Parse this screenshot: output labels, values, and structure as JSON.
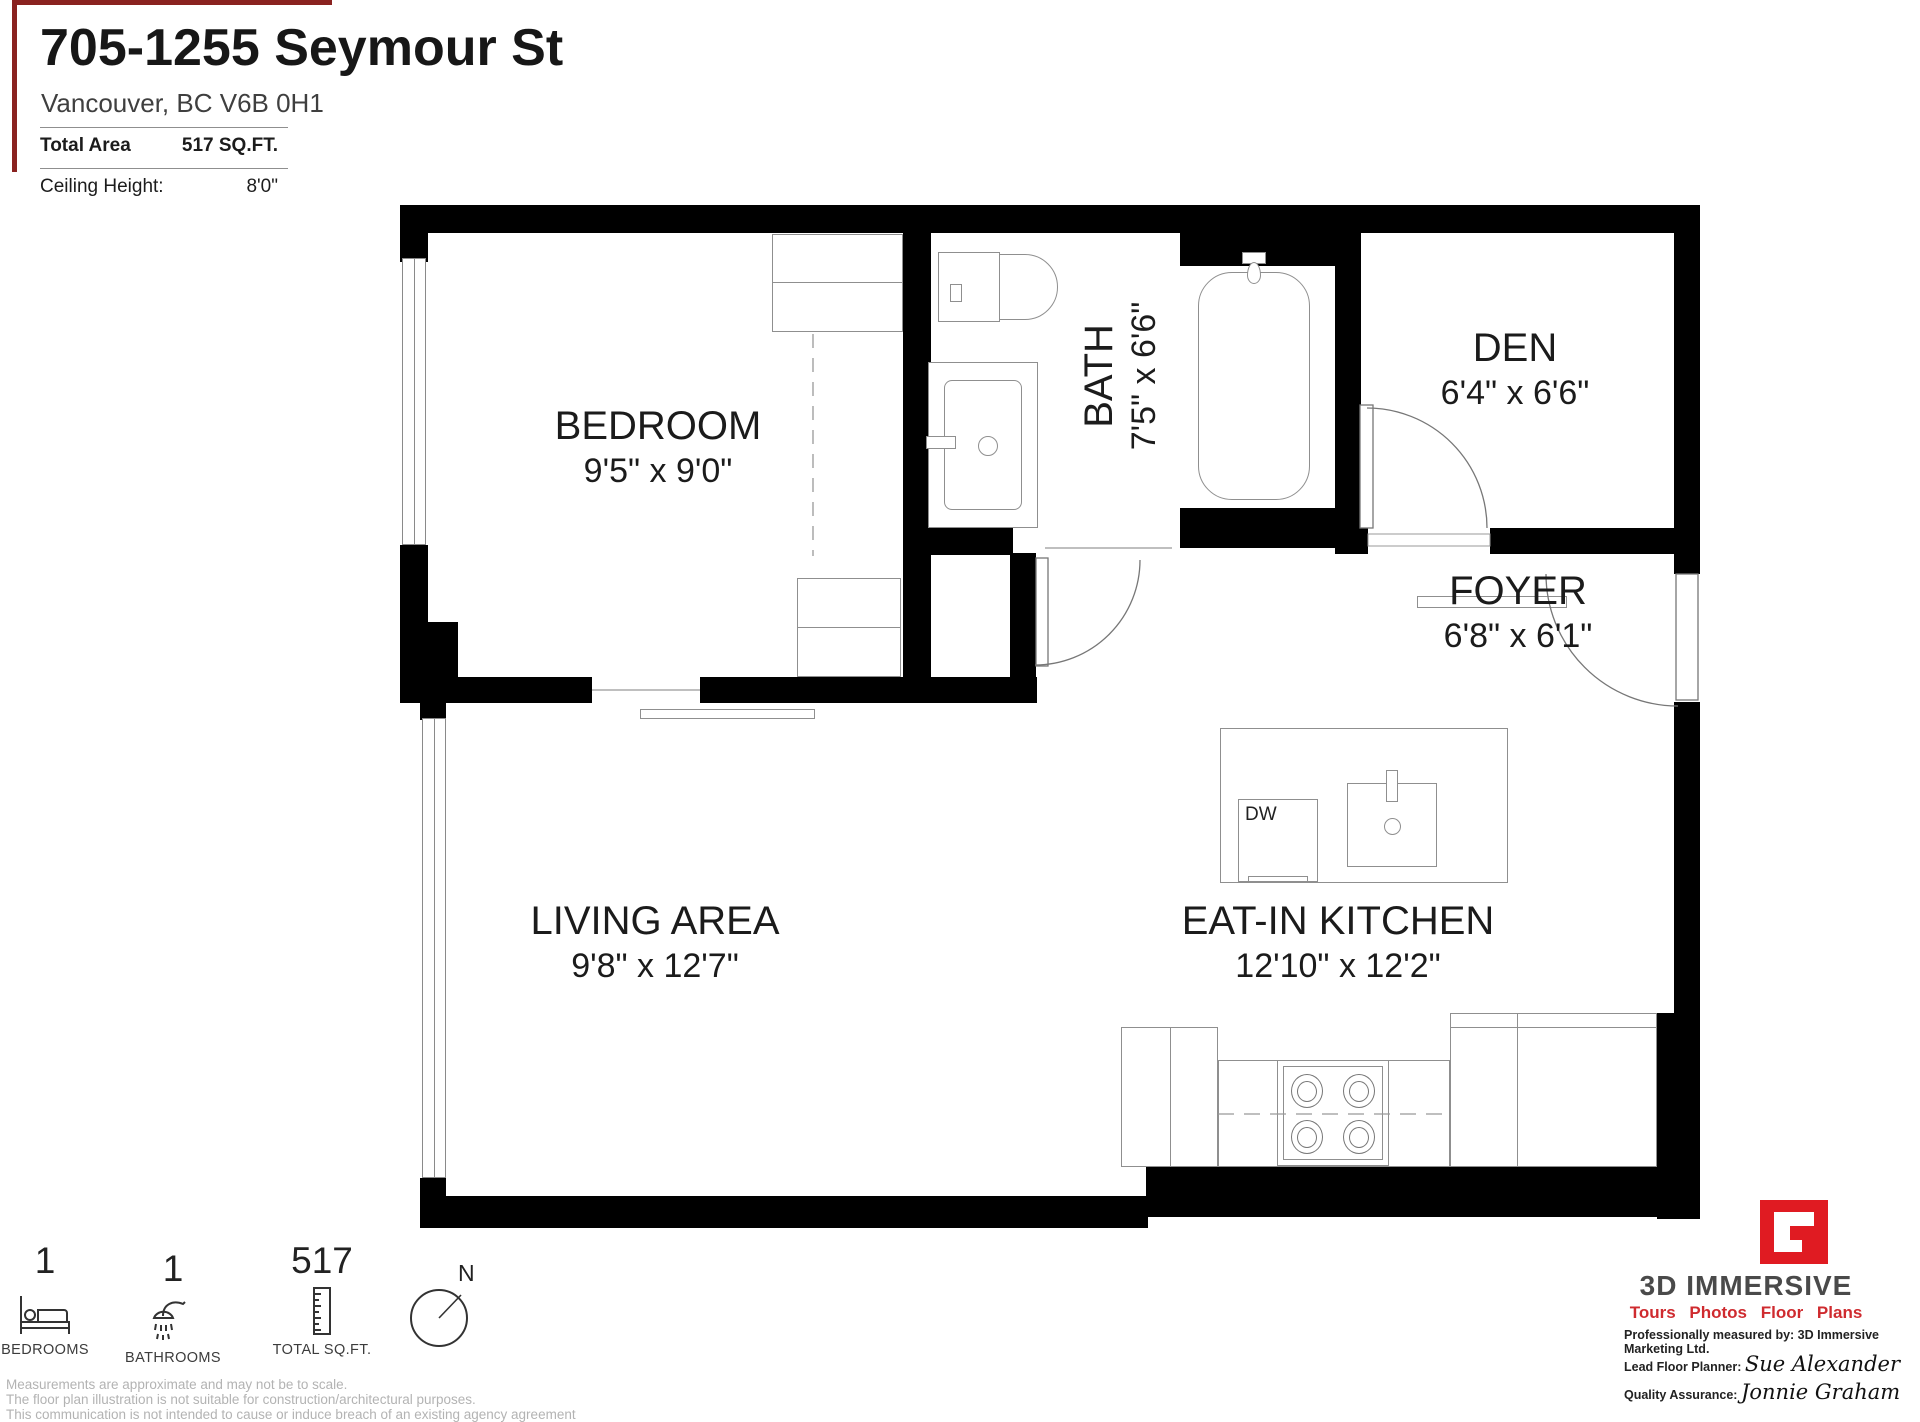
{
  "header": {
    "title": "705-1255 Seymour St",
    "address": "Vancouver, BC V6B 0H1",
    "total_area_label": "Total Area",
    "total_area_value": "517 SQ.FT.",
    "ceiling_label": "Ceiling Height:",
    "ceiling_value": "8'0\""
  },
  "rooms": {
    "bedroom": {
      "name": "BEDROOM",
      "dims": "9'5\" x 9'0\""
    },
    "bath": {
      "name": "BATH",
      "dims": "7'5\" x 6'6\""
    },
    "den": {
      "name": "DEN",
      "dims": "6'4\" x 6'6\""
    },
    "foyer": {
      "name": "FOYER",
      "dims": "6'8\" x 6'1\""
    },
    "living": {
      "name": "LIVING AREA",
      "dims": "9'8\" x 12'7\""
    },
    "kitchen": {
      "name": "EAT-IN KITCHEN",
      "dims": "12'10\" x 12'2\""
    }
  },
  "fixtures": {
    "dishwasher": "DW"
  },
  "stats": [
    {
      "value": "1",
      "label": "BEDROOMS",
      "icon": "bed-icon"
    },
    {
      "value": "1",
      "label": "BATHROOMS",
      "icon": "shower-icon"
    },
    {
      "value": "517",
      "label": "TOTAL SQ.FT.",
      "icon": "ruler-icon"
    }
  ],
  "compass": {
    "label": "N"
  },
  "branding": {
    "company": "3D IMMERSIVE",
    "tagline": "Tours  Photos  Floor Plans",
    "measured_by": "Professionally measured by: 3D Immersive Marketing Ltd.",
    "planner_label": "Lead Floor Planner:",
    "planner_name": "Sue Alexander",
    "qa_label": "Quality Assurance:",
    "qa_name": "Jonnie Graham",
    "brand_red": "#e01b22",
    "brand_gray": "#4a4a4a",
    "accent_border": "#8a2220"
  },
  "disclaimer": [
    "Measurements are approximate and may not be to scale.",
    "The floor plan illustration is not suitable for construction/architectural purposes.",
    "This communication is not intended to cause or induce breach of an existing agency agreement"
  ]
}
